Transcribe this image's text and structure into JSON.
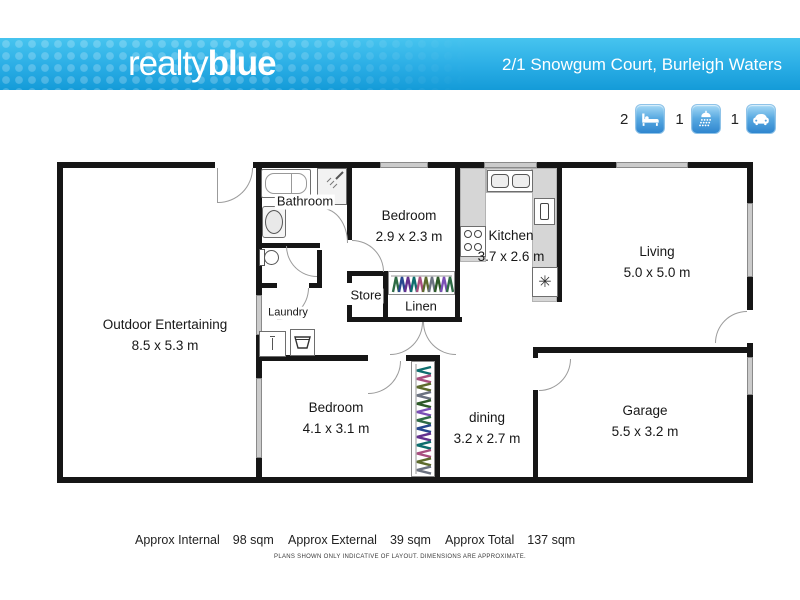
{
  "header": {
    "logo_regular": "realty",
    "logo_bold": "blue",
    "address": "2/1 Snowgum Court, Burleigh Waters"
  },
  "summary": {
    "items": [
      {
        "icon": "bed-icon",
        "count": "2"
      },
      {
        "icon": "shower-icon",
        "count": "1"
      },
      {
        "icon": "car-icon",
        "count": "1"
      }
    ]
  },
  "floorplan": {
    "rooms": [
      {
        "name": "Outdoor Entertaining",
        "dims": "8.5 x 5.3 m"
      },
      {
        "name": "Bedroom",
        "dims": "2.9 x 2.3 m"
      },
      {
        "name": "Kitchen",
        "dims": "3.7 x 2.6 m"
      },
      {
        "name": "Living",
        "dims": "5.0 x 5.0 m"
      },
      {
        "name": "Bedroom",
        "dims": "4.1 x 3.1 m"
      },
      {
        "name": "dining",
        "dims": "3.2 x 2.7 m"
      },
      {
        "name": "Garage",
        "dims": "5.5 x 3.2 m"
      }
    ],
    "small_labels": [
      "Bathroom",
      "Store",
      "Linen",
      "Laundry"
    ],
    "fridge_symbol": "✳"
  },
  "footer": {
    "areas": [
      {
        "label": "Approx Internal",
        "value": "98 sqm"
      },
      {
        "label": "Approx External",
        "value": "39 sqm"
      },
      {
        "label": "Approx Total",
        "value": "137 sqm"
      }
    ],
    "disclaimer": "PLANS SHOWN ONLY INDICATIVE OF LAYOUT.  DIMENSIONS ARE APPROXIMATE."
  },
  "colors": {
    "header_blue": "#29ade5",
    "wall": "#161616",
    "icon_blue": "#4a9bd9"
  }
}
